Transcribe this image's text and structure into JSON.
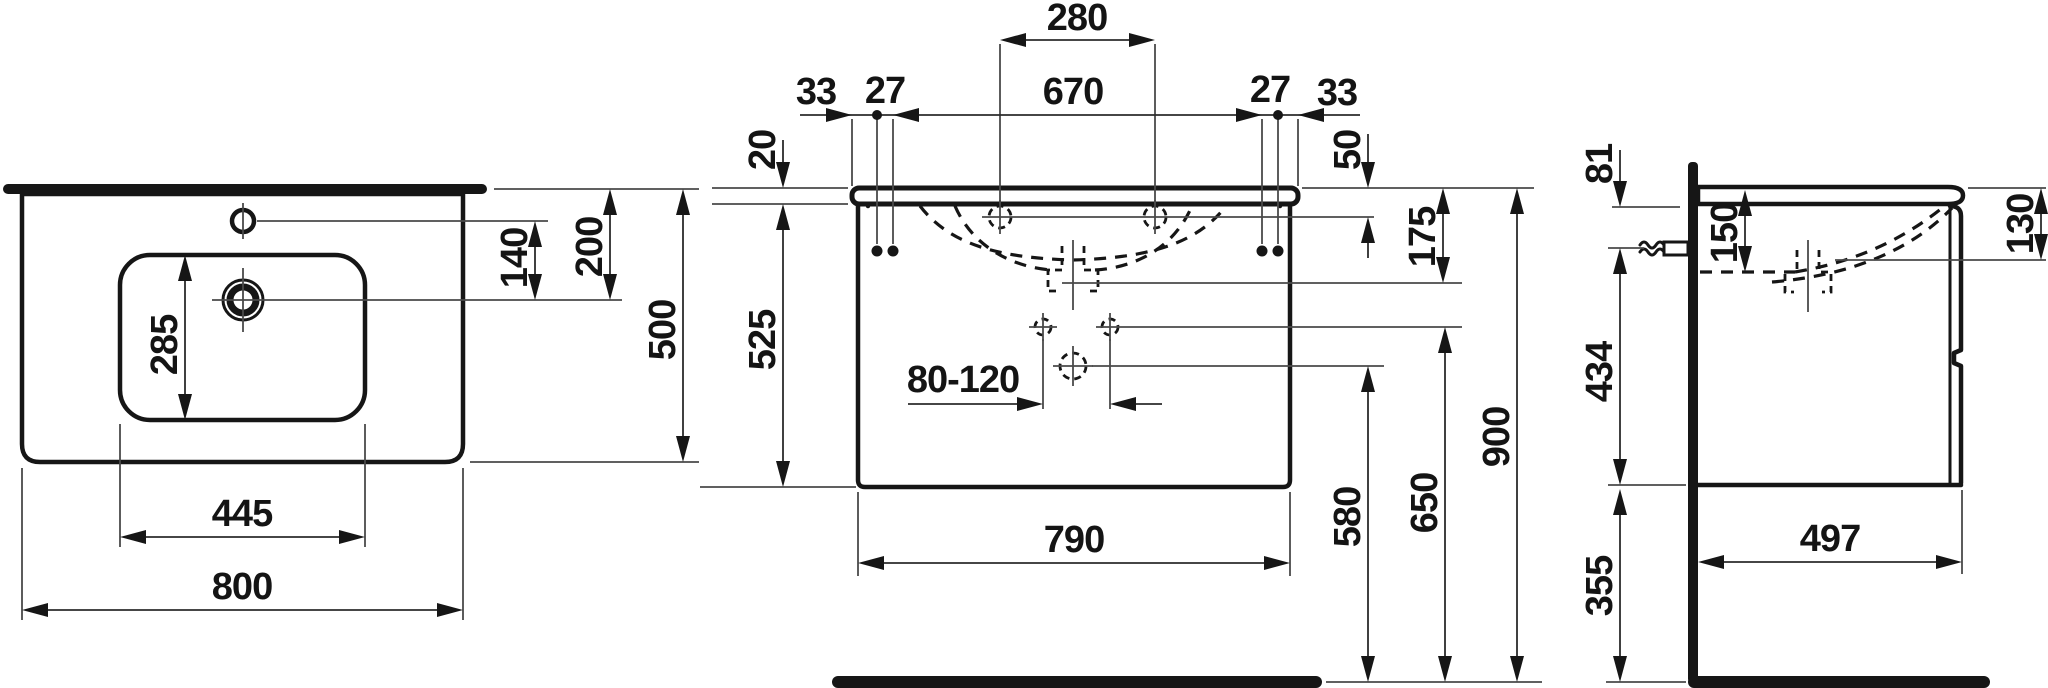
{
  "drawing": {
    "type": "technical-dimension-drawing",
    "subject": "washbasin with vanity unit, three orthographic views (plan, front, side)",
    "units": "mm",
    "colors": {
      "background": "#ffffff",
      "line": "#161616"
    }
  },
  "dims": {
    "top_view": {
      "basin_width": "800",
      "basin_depth": "500",
      "bowl_width": "445",
      "bowl_depth": "285",
      "tap_to_drain": "140",
      "rear_to_drain": "200"
    },
    "front_view": {
      "tap_spacing": "280",
      "fixing_span": "670",
      "edge_offset_left": "33",
      "hole_gap_left": "27",
      "hole_gap_right": "27",
      "edge_offset_right": "33",
      "top_thickness": "20",
      "rim_to_tap": "50",
      "rim_to_overflow": "175",
      "cabinet_height": "525",
      "trap_range": "80-120",
      "cabinet_width": "790",
      "outlet_to_floor": "580",
      "fixing_to_floor": "650",
      "rim_to_floor": "900"
    },
    "side_view": {
      "rim_to_bracket": "81",
      "bowl_inner_depth": "150",
      "rim_to_outlet": "130",
      "bracket_to_base": "434",
      "base_to_floor": "355",
      "cabinet_depth": "497"
    }
  }
}
